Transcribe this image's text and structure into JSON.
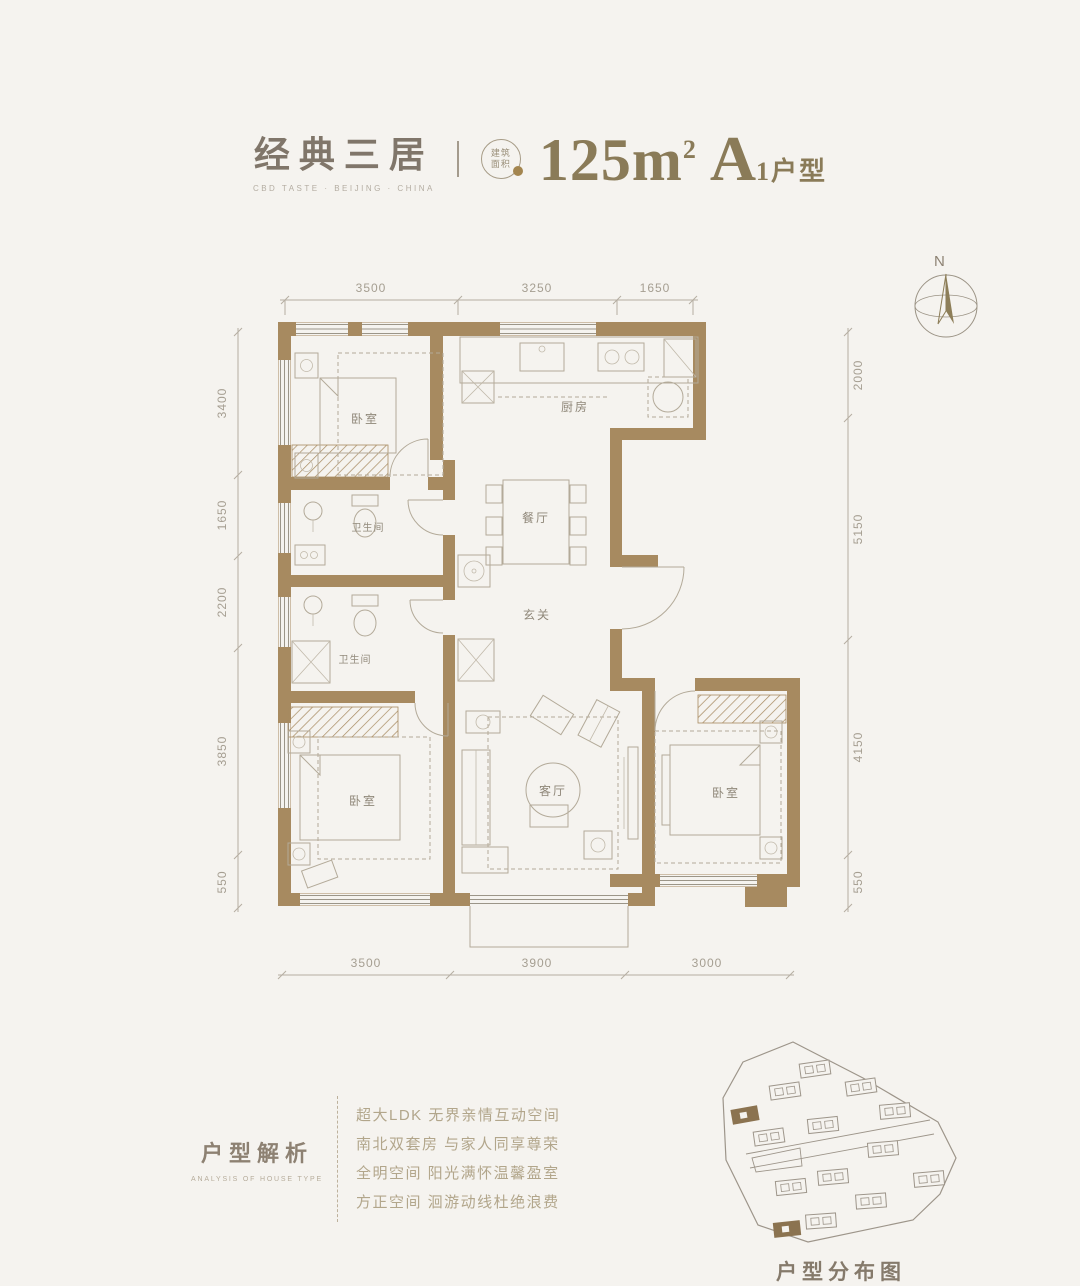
{
  "header": {
    "title": "经典三居",
    "subtitle": "CBD TASTE · BEIJING · CHINA",
    "badge_line1": "建筑",
    "badge_line2": "面积",
    "area_value": "125m",
    "area_sup": "2",
    "unit_letter": "A",
    "unit_rest": "1户型"
  },
  "compass": {
    "label": "N"
  },
  "floorplan": {
    "rooms": {
      "bedroom_nw": "卧室",
      "kitchen": "厨房",
      "dining": "餐厅",
      "foyer": "玄关",
      "bath_upper": "卫生间",
      "bath_lower": "卫生间",
      "living": "客厅",
      "bedroom_sw": "卧室",
      "bedroom_se": "卧室"
    },
    "dimensions": {
      "top": [
        "3500",
        "3250",
        "1650"
      ],
      "bottom": [
        "3500",
        "3900",
        "3000"
      ],
      "left": [
        "3400",
        "1650",
        "2200",
        "3850",
        "550"
      ],
      "right": [
        "2000",
        "5150",
        "4150",
        "550"
      ]
    }
  },
  "analysis": {
    "title": "户型解析",
    "subtitle": "ANALYSIS OF HOUSE TYPE",
    "lines": [
      "超大LDK 无界亲情互动空间",
      "南北双套房 与家人同享尊荣",
      "全明空间 阳光满怀温馨盈室",
      "方正空间 洄游动线杜绝浪费"
    ]
  },
  "sitemap": {
    "title": "户型分布图"
  },
  "colors": {
    "background": "#f5f3ef",
    "wall": "#a78a60",
    "accent": "#8a7b58",
    "dim_text": "#a59e91"
  }
}
